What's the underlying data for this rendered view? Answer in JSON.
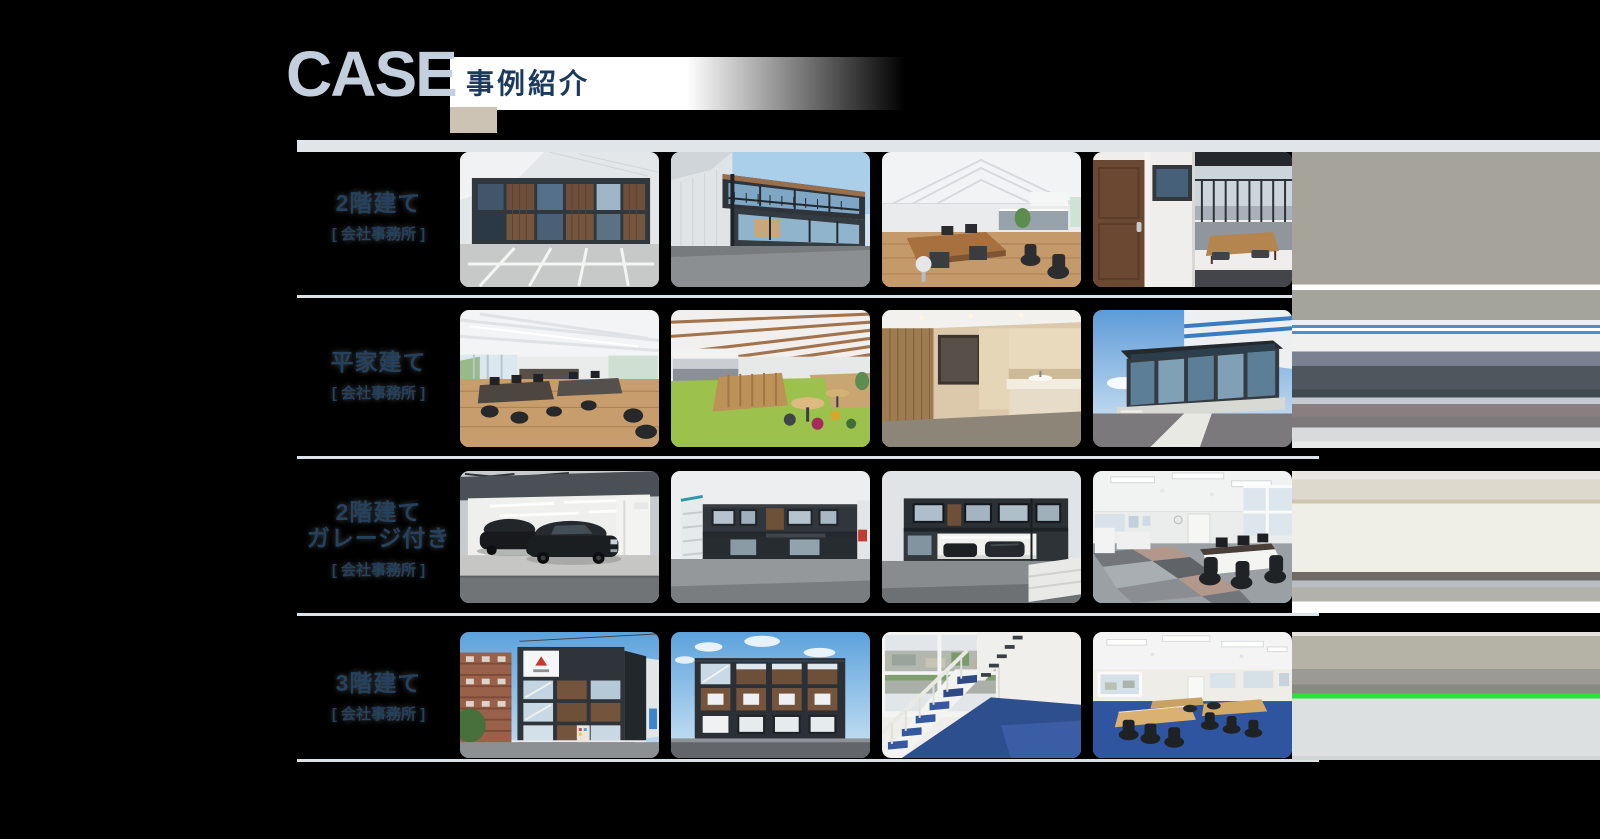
{
  "header": {
    "title": "CASE",
    "subtitle": "事例紹介"
  },
  "rows": [
    {
      "title": "2階建て",
      "subtitle": "[ 会社事務所 ]",
      "photos": [
        {
          "alt": "2階建てコンテナ事務所の外観と駐車場"
        },
        {
          "alt": "バルコニー付き2階建てコンテナ事務所の外観"
        },
        {
          "alt": "白い天井と木目デスクのオフィス内観"
        },
        {
          "alt": "木製ドアとバルコニーへの開口部の内観"
        }
      ]
    },
    {
      "title": "平家建て",
      "subtitle": "[ 会社事務所 ]",
      "photos": [
        {
          "alt": "木の床のオープンオフィス内観"
        },
        {
          "alt": "緑のカーペットのラウンジとキッチン"
        },
        {
          "alt": "木目パネルの洗面スペース"
        },
        {
          "alt": "ガラス張り平家事務所の外観"
        }
      ]
    },
    {
      "title": "2階建て",
      "title2": "ガレージ付き",
      "subtitle": "[ 会社事務所 ]",
      "photos": [
        {
          "alt": "黒い車2台が入るガレージの内観"
        },
        {
          "alt": "外階段付き2階建て事務所の外観"
        },
        {
          "alt": "ガレージ付き2階建て事務所の外観"
        },
        {
          "alt": "市松模様カーペットの事務所内観"
        }
      ]
    },
    {
      "title": "3階建て",
      "subtitle": "[ 会社事務所 ]",
      "photos": [
        {
          "alt": "3階建てコンテナ事務所の外観(角から)"
        },
        {
          "alt": "3階建てコンテナ事務所の正面外観"
        },
        {
          "alt": "青い踏板の白い鉄骨階段"
        },
        {
          "alt": "青いカーペットの会議室内観"
        }
      ]
    }
  ],
  "colors": {
    "accent_navy": "#1b3a5c",
    "heading_pale": "#c3cfdc",
    "stripe_blue": "#4a8fd2",
    "separator_gray": "#dce1e5",
    "smear_green": "#2ee23c",
    "background": "#000000"
  }
}
